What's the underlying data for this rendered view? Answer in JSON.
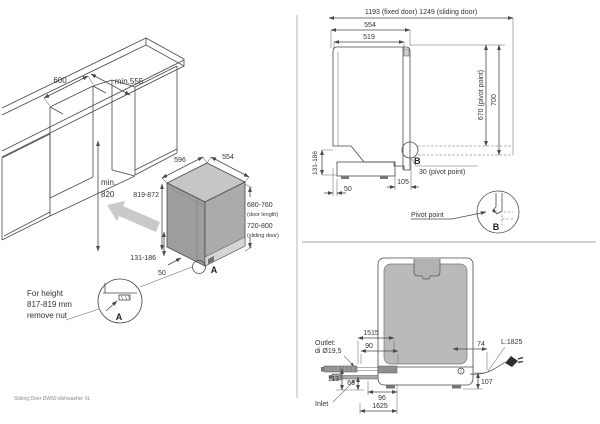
{
  "footer": "Sliding Door DW60 dishwasher XL",
  "iso": {
    "w600": "600",
    "d555": "min.555",
    "min1": "min.",
    "min2": "820",
    "d596": "596",
    "w554": "554",
    "h_adj": "819-872",
    "door_len": "680-760",
    "door_len_note": "(door length)",
    "slide_len": "720-800",
    "slide_note": "(sliding door)",
    "plinth": "131-186",
    "d50": "50",
    "marker": "A",
    "note": [
      "For height",
      "817-819 mm",
      "remove nut"
    ],
    "detail_label": "A"
  },
  "side": {
    "total": "1193 (fixed door) 1249 (sliding door)",
    "w554": "554",
    "w519": "519",
    "p670": "670 (pivot point)",
    "h700": "700",
    "plinth": "131-186",
    "d50": "50",
    "d105": "105",
    "p30": "30 (pivot point)",
    "marker": "B",
    "detail_title": "Pivot point",
    "detail_label": "B"
  },
  "rear": {
    "l1515": "1515",
    "d90": "90",
    "d74": "74",
    "cord": "L:1825",
    "h113": "113",
    "h66": "66",
    "w96": "96",
    "l1625": "1625",
    "h107": "107",
    "outlet1": "Outlet:",
    "outlet2": "di Ø19,5",
    "inlet": "Inlet"
  },
  "colors": {
    "line": "#4a4a4a",
    "dw_left": "#9e9e9e",
    "dw_right": "#ababab",
    "dw_top": "#c6c6c6",
    "body_gray": "#b5b5b5",
    "arrow_gray": "#c9c9c9"
  }
}
